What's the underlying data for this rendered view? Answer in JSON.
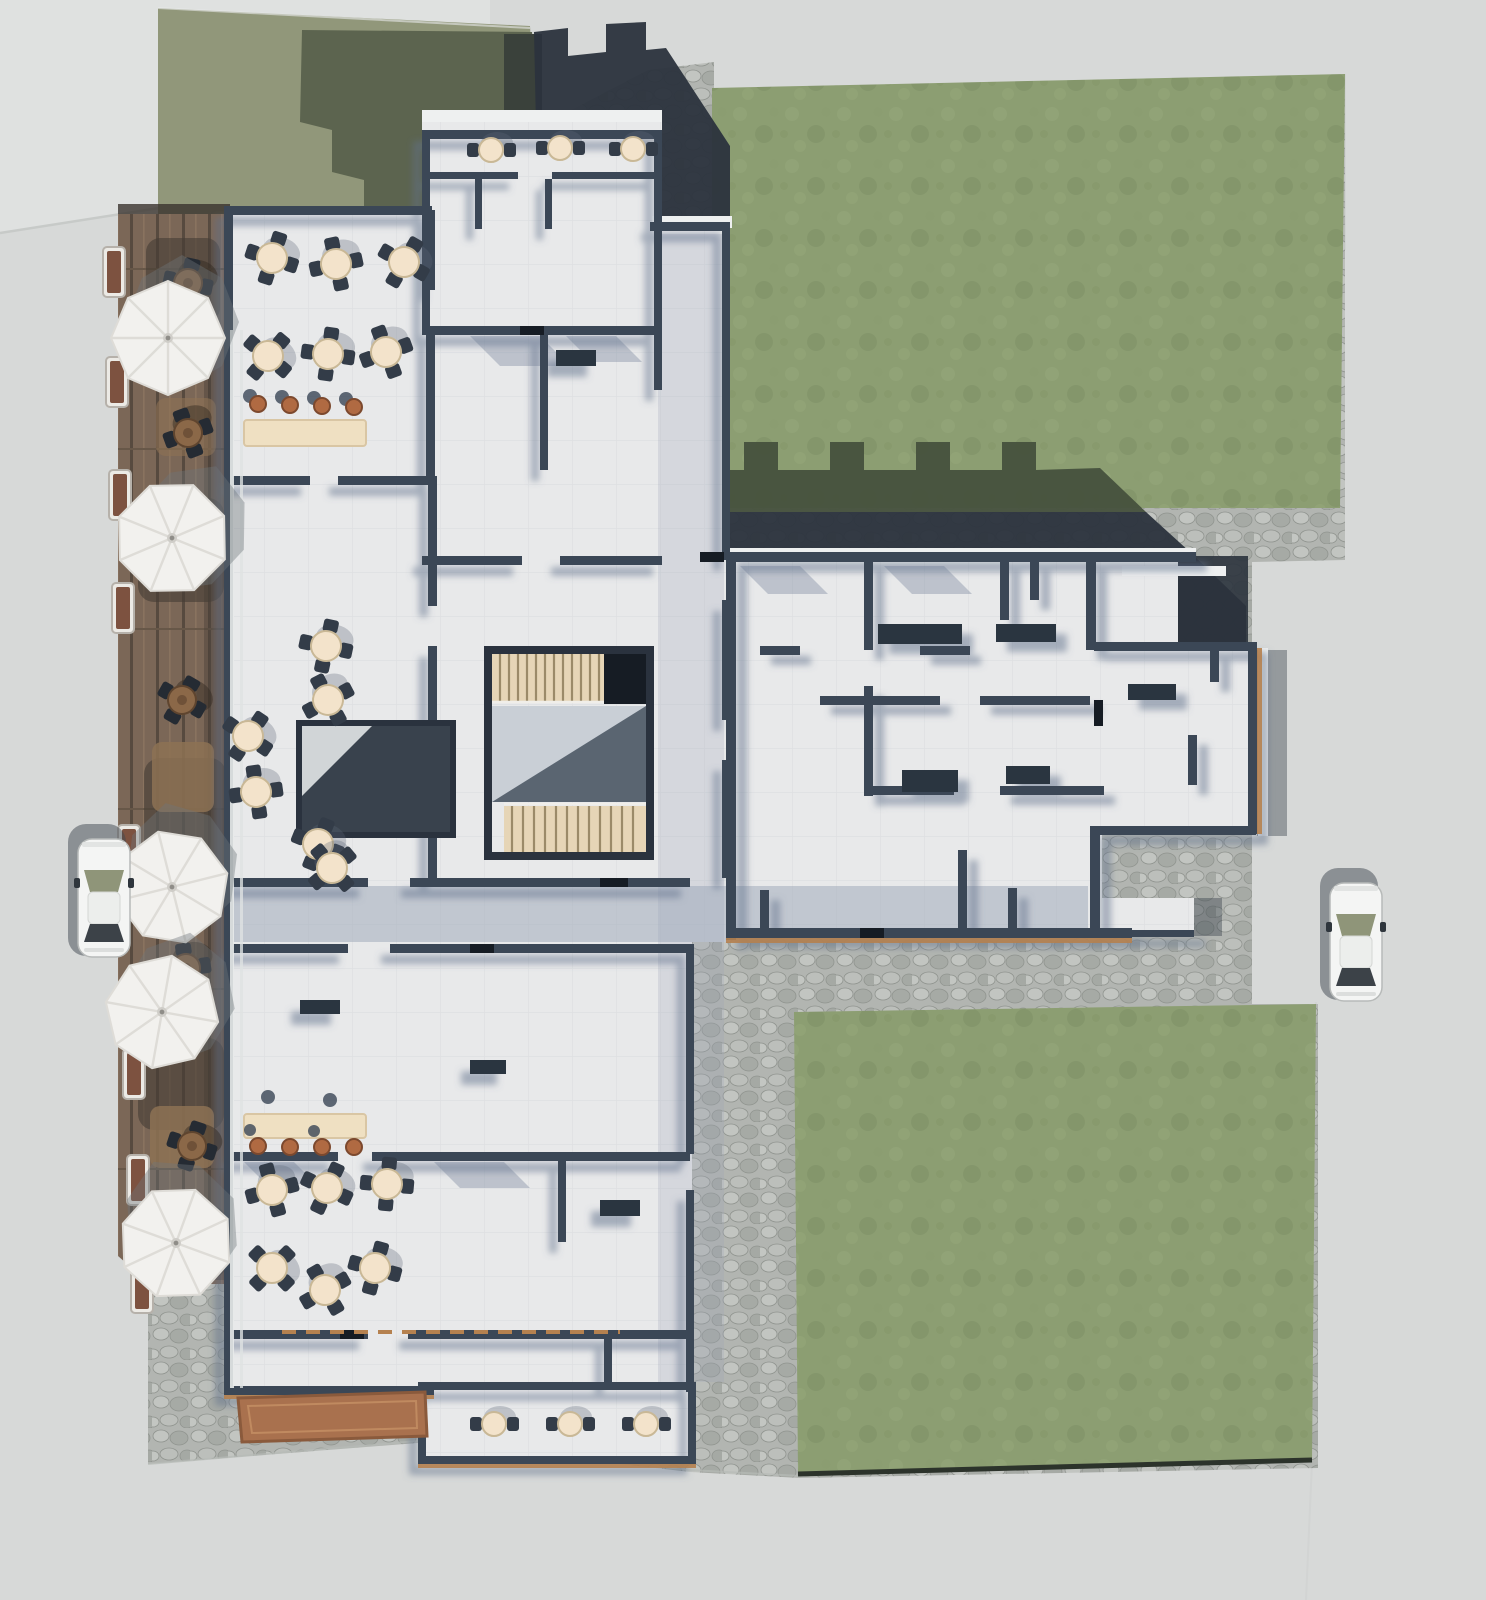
{
  "meta": {
    "title": "Top-down 3D architectural rendering — cut-away floor plan of a mixed-use building with site",
    "view": "aerial orthographic render",
    "visible_text": ""
  },
  "palette": {
    "road": "#d7d9d8",
    "parcelLight": "#dfe1e0",
    "boundary": "#c7cac8",
    "olive": "#91977a",
    "oliveShadow": "#5c644f",
    "silhouette": "#3a413b",
    "lawn": "#8c9e72",
    "lawnBlobLight": "#95a779",
    "lawnBlobDark": "#7e9065",
    "lawnShadow": "#46513d",
    "lawnEdge": "#2c332b",
    "shadowDark": "#2b333d",
    "cobbleBase": "#b2b5b1",
    "cobbleLight": "#c2c5c1",
    "cobbleDark": "#a6aaa5",
    "cobbleLine": "#90948f",
    "deck": "#7b6757",
    "deckJoint": "#574a3f",
    "deckLight": "#89735f",
    "deckShadow": "#453c34",
    "deckTan": "#8d7254",
    "floor": "#e8e9ea",
    "floorLine": "#dee0e2",
    "wall": "#3a4656",
    "wallDark": "#2a323e",
    "wallSide": "#76839b",
    "black": "#161c24",
    "corridor": "#9aa5b6",
    "stairWood": "#e6d5b6",
    "stairTread": "#9b8a68",
    "landing": "#c9cfd6",
    "landingShadow": "#46525f",
    "umbrella": "#f2f1ee",
    "umbrellaRib": "#dedcd7",
    "umbrellaShadow": "#6f757b",
    "tableTop": "#f3e3cb",
    "tableEdge": "#c9b896",
    "chair": "#333c48",
    "chairShadow": "#5d6878",
    "stool": "#b06a42",
    "stoolEdge": "#7c492e",
    "counter": "#efe0c2",
    "counterEdge": "#d9c6a4",
    "trim": "#b5814f",
    "brownMat": "#a9714e",
    "brownMatEdge": "#8a5a3c",
    "desk": "#2b3440",
    "carBody": "#f4f5f4",
    "carGlass": "#3c4248",
    "carWindshield": "#8f9579",
    "carShadow": "#40474f"
  },
  "scene": {
    "site": {
      "surround": "light gray road on all four sides",
      "neighbor_parcel": "lighter gray parcel, top-left corner",
      "olive_parcel": "olive green neighboring plot top-left with cast building shadow",
      "lawn_areas": 2,
      "paving": "cobblestone apron wrapping north, east and south of building",
      "timber_deck": "west facade terrace deck with parasols"
    },
    "building": {
      "type": "cut-away floor plan (walls sectioned)",
      "floor_finish": "white",
      "stair_cores": 2,
      "elevator_shafts": 1,
      "wings": [
        "north rooms",
        "west block",
        "east wing",
        "north-east room",
        "south room"
      ]
    },
    "furniture": {
      "parasols": 5,
      "deck_table_sets": 5,
      "terrace_tables": 6,
      "north_room_tables": 3,
      "lounge_tables": 6,
      "south_dining_tables": 6,
      "south_room_tables": 3,
      "bar_counters": 2,
      "bar_stools_terracotta": 8,
      "planters": 8
    },
    "vehicles": {
      "cars": 2,
      "car_color": "white",
      "orientation": "parked facing north"
    }
  }
}
